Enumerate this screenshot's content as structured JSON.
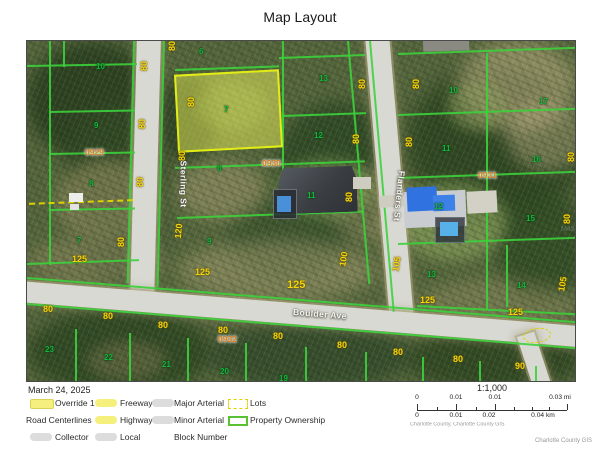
{
  "title": "Map Layout",
  "date": "March 24, 2025",
  "legend": {
    "items": [
      {
        "label": "Override 1",
        "swatch": "fill-yellow",
        "col": 0,
        "row": 0
      },
      {
        "label": "Road Centerlines",
        "swatch": "none",
        "col": 0,
        "row": 1,
        "headline": true
      },
      {
        "label": "Collector",
        "swatch": "line-gray",
        "col": 0,
        "row": 2
      },
      {
        "label": "Freeway",
        "swatch": "line-yellow",
        "col": 1,
        "row": 0
      },
      {
        "label": "Highway",
        "swatch": "line-yellow",
        "col": 1,
        "row": 1
      },
      {
        "label": "Local",
        "swatch": "line-gray",
        "col": 1,
        "row": 2
      },
      {
        "label": "Major Arterial",
        "swatch": "line-gray",
        "col": 2,
        "row": 0
      },
      {
        "label": "Minor Arterial",
        "swatch": "line-gray",
        "col": 2,
        "row": 1
      },
      {
        "label": "Block Number",
        "swatch": "none",
        "col": 2,
        "row": 2
      },
      {
        "label": "Lots",
        "swatch": "dash-yellow",
        "col": 3,
        "row": 0
      },
      {
        "label": "Property Ownership",
        "swatch": "outline-green",
        "col": 3,
        "row": 1
      }
    ]
  },
  "scalebar": {
    "ratio": "1:1,000",
    "mi_labels": [
      "0",
      "0.01",
      "0.01",
      "0.03 mi"
    ],
    "km_labels": [
      "0",
      "0.01",
      "0.02",
      "0.04 km"
    ],
    "attribution": "Charlotte County, Charlotte County GIS"
  },
  "corner_attribution": "Charlotte County GIS",
  "map": {
    "streets": [
      {
        "name": "Sterling St",
        "x": 133,
        "y": 138,
        "rot": 90
      },
      {
        "name": "Flanders St",
        "x": 347,
        "y": 150,
        "rot": 96
      },
      {
        "name": "Boulder Ave",
        "x": 266,
        "y": 268,
        "rot": 4.5
      }
    ],
    "lot_numbers": [
      {
        "text": "10",
        "x": 69,
        "y": 21
      },
      {
        "text": "9",
        "x": 67,
        "y": 80
      },
      {
        "text": "8",
        "x": 62,
        "y": 138
      },
      {
        "text": "7",
        "x": 50,
        "y": 195
      },
      {
        "text": "6",
        "x": 172,
        "y": 6
      },
      {
        "text": "7",
        "x": 197,
        "y": 64
      },
      {
        "text": "8",
        "x": 190,
        "y": 123
      },
      {
        "text": "13",
        "x": 292,
        "y": 33
      },
      {
        "text": "12",
        "x": 287,
        "y": 90
      },
      {
        "text": "11",
        "x": 280,
        "y": 150
      },
      {
        "text": "9",
        "x": 180,
        "y": 196
      },
      {
        "text": "10",
        "x": 422,
        "y": 45
      },
      {
        "text": "17",
        "x": 512,
        "y": 56
      },
      {
        "text": "11",
        "x": 415,
        "y": 103
      },
      {
        "text": "16",
        "x": 505,
        "y": 114
      },
      {
        "text": "12",
        "x": 407,
        "y": 161
      },
      {
        "text": "15",
        "x": 499,
        "y": 173
      },
      {
        "text": "13",
        "x": 400,
        "y": 229
      },
      {
        "text": "14",
        "x": 490,
        "y": 240
      },
      {
        "text": "23",
        "x": 18,
        "y": 304
      },
      {
        "text": "22",
        "x": 77,
        "y": 312
      },
      {
        "text": "21",
        "x": 135,
        "y": 319
      },
      {
        "text": "20",
        "x": 193,
        "y": 326
      },
      {
        "text": "19",
        "x": 252,
        "y": 333
      }
    ],
    "dimension_labels": [
      {
        "text": "80",
        "x": 112,
        "y": 20,
        "rot": -90
      },
      {
        "text": "80",
        "x": 110,
        "y": 78,
        "rot": -90
      },
      {
        "text": "80",
        "x": 108,
        "y": 136,
        "rot": -90
      },
      {
        "text": "80",
        "x": 89,
        "y": 196,
        "rot": -90
      },
      {
        "text": "80",
        "x": 140,
        "y": 0,
        "rot": -90
      },
      {
        "text": "80",
        "x": 159,
        "y": 56,
        "rot": -90
      },
      {
        "text": "80",
        "x": 150,
        "y": 110,
        "rot": -90
      },
      {
        "text": "80",
        "x": 330,
        "y": 38,
        "rot": -90
      },
      {
        "text": "80",
        "x": 324,
        "y": 93,
        "rot": -90
      },
      {
        "text": "80",
        "x": 317,
        "y": 151,
        "rot": -90
      },
      {
        "text": "80",
        "x": 384,
        "y": 38,
        "rot": -90
      },
      {
        "text": "80",
        "x": 377,
        "y": 96,
        "rot": -90
      },
      {
        "text": "80",
        "x": 539,
        "y": 111,
        "rot": -90
      },
      {
        "text": "80",
        "x": 535,
        "y": 173,
        "rot": -90
      },
      {
        "text": "120",
        "x": 144,
        "y": 185,
        "rot": -85
      },
      {
        "text": "100",
        "x": 309,
        "y": 213,
        "rot": -80
      },
      {
        "text": "105",
        "x": 362,
        "y": 218,
        "rot": -80
      },
      {
        "text": "105",
        "x": 528,
        "y": 238,
        "rot": -80
      },
      {
        "text": "125",
        "x": 45,
        "y": 213,
        "rot": 0
      },
      {
        "text": "125",
        "x": 168,
        "y": 226,
        "rot": 0
      },
      {
        "text": "125",
        "x": 260,
        "y": 238,
        "rot": 0,
        "big": true
      },
      {
        "text": "125",
        "x": 393,
        "y": 254,
        "rot": 0
      },
      {
        "text": "125",
        "x": 481,
        "y": 266,
        "rot": 0
      },
      {
        "text": "80",
        "x": 16,
        "y": 263,
        "rot": 0
      },
      {
        "text": "80",
        "x": 76,
        "y": 270,
        "rot": 0
      },
      {
        "text": "80",
        "x": 131,
        "y": 279,
        "rot": 0
      },
      {
        "text": "80",
        "x": 191,
        "y": 284,
        "rot": 0
      },
      {
        "text": "80",
        "x": 246,
        "y": 290,
        "rot": 0
      },
      {
        "text": "80",
        "x": 310,
        "y": 299,
        "rot": 0
      },
      {
        "text": "80",
        "x": 366,
        "y": 306,
        "rot": 0
      },
      {
        "text": "80",
        "x": 426,
        "y": 313,
        "rot": 0
      },
      {
        "text": "90",
        "x": 488,
        "y": 320,
        "rot": 0
      }
    ],
    "block_numbers": [
      {
        "text": "0929",
        "x": 58,
        "y": 106
      },
      {
        "text": "0930",
        "x": 235,
        "y": 117
      },
      {
        "text": "0931",
        "x": 451,
        "y": 129
      },
      {
        "text": "0932",
        "x": 191,
        "y": 293
      }
    ],
    "watermark": "M45"
  }
}
